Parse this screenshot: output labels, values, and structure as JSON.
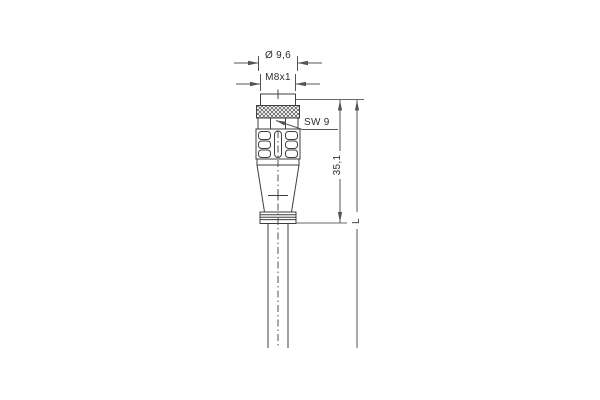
{
  "drawing": {
    "labels": {
      "diameter": "Ø 9,6",
      "thread": "M8x1",
      "wrench_size": "SW 9",
      "connector_length": "35,1",
      "cable_length": "L"
    },
    "colors": {
      "background": "#ffffff",
      "outline": "#3f3f3f",
      "dimension_lines": "#555555",
      "text": "#2e2e2e"
    }
  }
}
